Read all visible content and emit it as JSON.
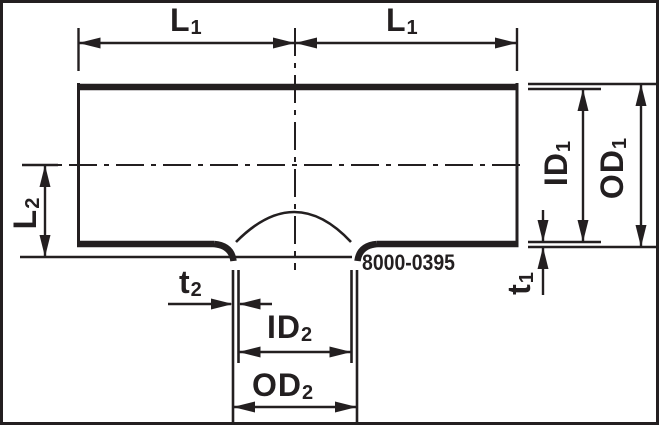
{
  "drawing": {
    "title": "reducing-tee-fitting-dimension-drawing",
    "part_number": "8000-0395",
    "labels": {
      "length_main": {
        "main": "L",
        "sub": "1"
      },
      "length_branch": {
        "main": "L",
        "sub": "2"
      },
      "inner_diameter_main": {
        "main": "ID",
        "sub": "1"
      },
      "outer_diameter_main": {
        "main": "OD",
        "sub": "1"
      },
      "wall_thickness_main": {
        "main": "t",
        "sub": "1"
      },
      "wall_thickness_branch": {
        "main": "t",
        "sub": "2"
      },
      "inner_diameter_branch": {
        "main": "ID",
        "sub": "2"
      },
      "outer_diameter_branch": {
        "main": "OD",
        "sub": "2"
      }
    },
    "colors": {
      "line": "#231f20",
      "background": "#ffffff"
    }
  }
}
